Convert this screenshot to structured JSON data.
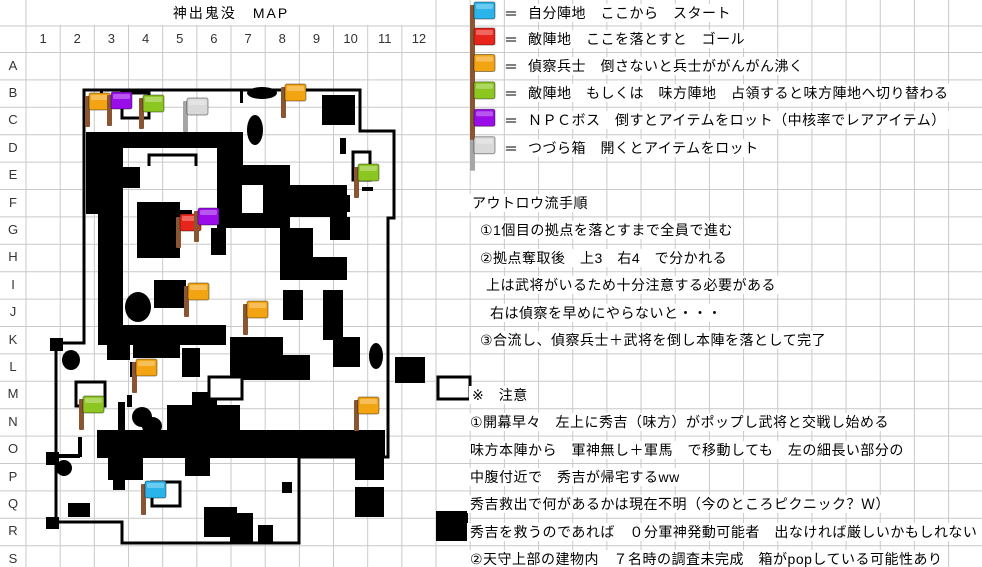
{
  "title": "神出鬼没　MAP",
  "sheet": {
    "columns": [
      "1",
      "2",
      "3",
      "4",
      "5",
      "6",
      "7",
      "8",
      "9",
      "10",
      "11",
      "12"
    ],
    "rows": [
      "A",
      "B",
      "C",
      "D",
      "E",
      "F",
      "G",
      "H",
      "I",
      "J",
      "K",
      "L",
      "M",
      "N",
      "O",
      "P",
      "Q",
      "R",
      "S"
    ]
  },
  "legend": {
    "eq": "＝",
    "items": [
      {
        "id": "own-base",
        "color": "cyan",
        "label": "自分陣地　ここから　スタート"
      },
      {
        "id": "enemy-base-goal",
        "color": "red",
        "label": "敵陣地　ここを落とすと　ゴール"
      },
      {
        "id": "scout-soldier",
        "color": "orange",
        "label": "偵察兵士　倒さないと兵士ががんがん沸く"
      },
      {
        "id": "capturable-base",
        "color": "green",
        "label": "敵陣地　もしくは　味方陣地　占領すると味方陣地へ切り替わる"
      },
      {
        "id": "npc-boss",
        "color": "purple",
        "label": "ＮＰＣボス　倒すとアイテムをロット（中核率でレアアイテム）"
      },
      {
        "id": "treasure-box",
        "color": "gray",
        "label": "つづら箱　開くとアイテムをロット"
      }
    ]
  },
  "map": {
    "border_path": "M84,90 L360,90 L360,131 L394,131 L394,218 L388,218 L388,457 L299,457 L299,543 L122,543 L122,522 L56,522 L56,343 L84,343 Z",
    "bracket_path": "M149,166 L149,155 L196,155 L196,166",
    "walls": [
      [
        102,
        132,
        141,
        16
      ],
      [
        86,
        132,
        37,
        82
      ],
      [
        98,
        214,
        25,
        131
      ],
      [
        123,
        167,
        17,
        21
      ],
      [
        137,
        202,
        43,
        56
      ],
      [
        180,
        210,
        12,
        17
      ],
      [
        211,
        228,
        15,
        27
      ],
      [
        217,
        148,
        26,
        80
      ],
      [
        322,
        95,
        33,
        30
      ],
      [
        340,
        138,
        6,
        16
      ],
      [
        332,
        195,
        18,
        17
      ],
      [
        362,
        187,
        11,
        4
      ],
      [
        330,
        217,
        20,
        23
      ],
      [
        230,
        165,
        60,
        63
      ],
      [
        290,
        185,
        57,
        32
      ],
      [
        280,
        228,
        33,
        52
      ],
      [
        312,
        257,
        35,
        23
      ],
      [
        323,
        290,
        20,
        50
      ],
      [
        283,
        290,
        20,
        30
      ],
      [
        154,
        280,
        32,
        28
      ],
      [
        119,
        325,
        107,
        20
      ],
      [
        230,
        337,
        53,
        43
      ],
      [
        283,
        355,
        27,
        25
      ],
      [
        333,
        337,
        27,
        30
      ],
      [
        107,
        340,
        23,
        20
      ],
      [
        133,
        340,
        47,
        18
      ],
      [
        182,
        348,
        18,
        29
      ],
      [
        130,
        362,
        7,
        15
      ],
      [
        167,
        405,
        73,
        28
      ],
      [
        192,
        392,
        25,
        13
      ],
      [
        118,
        402,
        7,
        28
      ],
      [
        127,
        395,
        5,
        12
      ],
      [
        97,
        430,
        288,
        28
      ],
      [
        68,
        503,
        22,
        14
      ],
      [
        204,
        507,
        33,
        30
      ],
      [
        282,
        482,
        10,
        11
      ],
      [
        355,
        458,
        29,
        22
      ],
      [
        355,
        487,
        29,
        30
      ],
      [
        436,
        511,
        32,
        30
      ],
      [
        395,
        357,
        30,
        26
      ],
      [
        230,
        513,
        23,
        30
      ],
      [
        258,
        525,
        15,
        18
      ],
      [
        108,
        458,
        35,
        22
      ],
      [
        113,
        480,
        12,
        10
      ],
      [
        185,
        458,
        25,
        18
      ],
      [
        100,
        90,
        3,
        13
      ],
      [
        240,
        90,
        3,
        13
      ],
      [
        78,
        437,
        4,
        20
      ],
      [
        56,
        454,
        24,
        4
      ],
      [
        50,
        338,
        13,
        13
      ],
      [
        46,
        452,
        13,
        13
      ],
      [
        46,
        517,
        13,
        12
      ]
    ],
    "white_hole": [
      242,
      185,
      21,
      28
    ],
    "ellipses": [
      [
        262,
        93,
        15,
        6
      ],
      [
        255,
        130,
        8,
        15
      ],
      [
        138,
        307,
        13,
        15
      ],
      [
        71,
        360,
        9,
        10
      ],
      [
        142,
        417,
        10,
        10
      ],
      [
        152,
        426,
        10,
        9
      ],
      [
        64,
        468,
        8,
        8
      ],
      [
        222,
        388,
        8,
        8
      ],
      [
        452,
        388,
        8,
        8
      ],
      [
        376,
        356,
        7,
        13
      ]
    ],
    "boxes": [
      [
        122,
        93,
        27,
        25
      ],
      [
        353,
        152,
        17,
        28
      ],
      [
        76,
        382,
        29,
        24
      ],
      [
        152,
        482,
        28,
        24
      ],
      [
        209,
        377,
        33,
        22
      ],
      [
        438,
        377,
        32,
        22
      ]
    ],
    "flags": [
      {
        "color": "orange",
        "x": 85,
        "y": 93,
        "grid": "B3"
      },
      {
        "color": "purple",
        "x": 107,
        "y": 92,
        "grid": "B3"
      },
      {
        "color": "green",
        "x": 139,
        "y": 95,
        "grid": "B4"
      },
      {
        "color": "gray",
        "x": 183,
        "y": 98,
        "grid": "B6"
      },
      {
        "color": "orange",
        "x": 281,
        "y": 84,
        "grid": "B8"
      },
      {
        "color": "green",
        "x": 354,
        "y": 164,
        "grid": "E10"
      },
      {
        "color": "red",
        "x": 176,
        "y": 214,
        "grid": "G5"
      },
      {
        "color": "purple",
        "x": 194,
        "y": 208,
        "grid": "G6"
      },
      {
        "color": "orange",
        "x": 184,
        "y": 283,
        "grid": "I5"
      },
      {
        "color": "orange",
        "x": 243,
        "y": 301,
        "grid": "J7"
      },
      {
        "color": "orange",
        "x": 132,
        "y": 359,
        "grid": "L4"
      },
      {
        "color": "green",
        "x": 79,
        "y": 396,
        "grid": "M2"
      },
      {
        "color": "orange",
        "x": 354,
        "y": 397,
        "grid": "N10"
      },
      {
        "color": "cyan",
        "x": 141,
        "y": 481,
        "grid": "Q4"
      }
    ]
  },
  "panel": {
    "lines": [
      {
        "section": "procedure",
        "row": "F",
        "x": 469,
        "text": "アウトロウ流手順"
      },
      {
        "section": "procedure",
        "row": "G",
        "x": 477,
        "text": "①1個目の拠点を落とすまで全員で進む"
      },
      {
        "section": "procedure",
        "row": "H",
        "x": 477,
        "text": "②拠点奪取後　上3　右4　で分かれる"
      },
      {
        "section": "procedure",
        "row": "I",
        "x": 483,
        "text": "上は武将がいるため十分注意する必要がある"
      },
      {
        "section": "procedure",
        "row": "J",
        "x": 487,
        "text": "右は偵察を早めにやらないと・・・"
      },
      {
        "section": "procedure",
        "row": "K",
        "x": 477,
        "text": "③合流し、偵察兵士＋武将を倒し本陣を落として完了"
      },
      {
        "section": "notes",
        "row": "M",
        "x": 469,
        "text": "※　注意"
      },
      {
        "section": "notes",
        "row": "N",
        "x": 467,
        "text": "①開幕早々　左上に秀吉（味方）がポップし武将と交戦し始める"
      },
      {
        "section": "notes",
        "row": "O",
        "x": 467,
        "text": "味方本陣から　軍神無し＋軍馬　で移動しても　左の細長い部分の"
      },
      {
        "section": "notes",
        "row": "P",
        "x": 467,
        "text": "中腹付近で　秀吉が帰宅するww"
      },
      {
        "section": "notes",
        "row": "Q",
        "x": 467,
        "text": "秀吉救出で何があるかは現在不明（今のところピクニック？Ｗ）"
      },
      {
        "section": "notes",
        "row": "R",
        "x": 467,
        "text": "秀吉を救うのであれば　０分軍神発動可能者　出なければ厳しいかもしれない"
      },
      {
        "section": "notes",
        "row": "S",
        "x": 467,
        "text": "②天守上部の建物内　７名時の調査未完成　箱がpopしている可能性あり"
      }
    ]
  },
  "colors": {
    "grid_line": "#c9c9c9",
    "map_black": "#000000",
    "text": "#000000",
    "label": "#333333",
    "flag": {
      "cyan": "#2AB4EA",
      "red": "#E8251B",
      "orange": "#F2A413",
      "green": "#8CC621",
      "purple": "#9A0DE8",
      "gray": "#D9D9D9"
    },
    "pole_brown": "#8A5533",
    "pole_gray": "#A6A6A6"
  }
}
